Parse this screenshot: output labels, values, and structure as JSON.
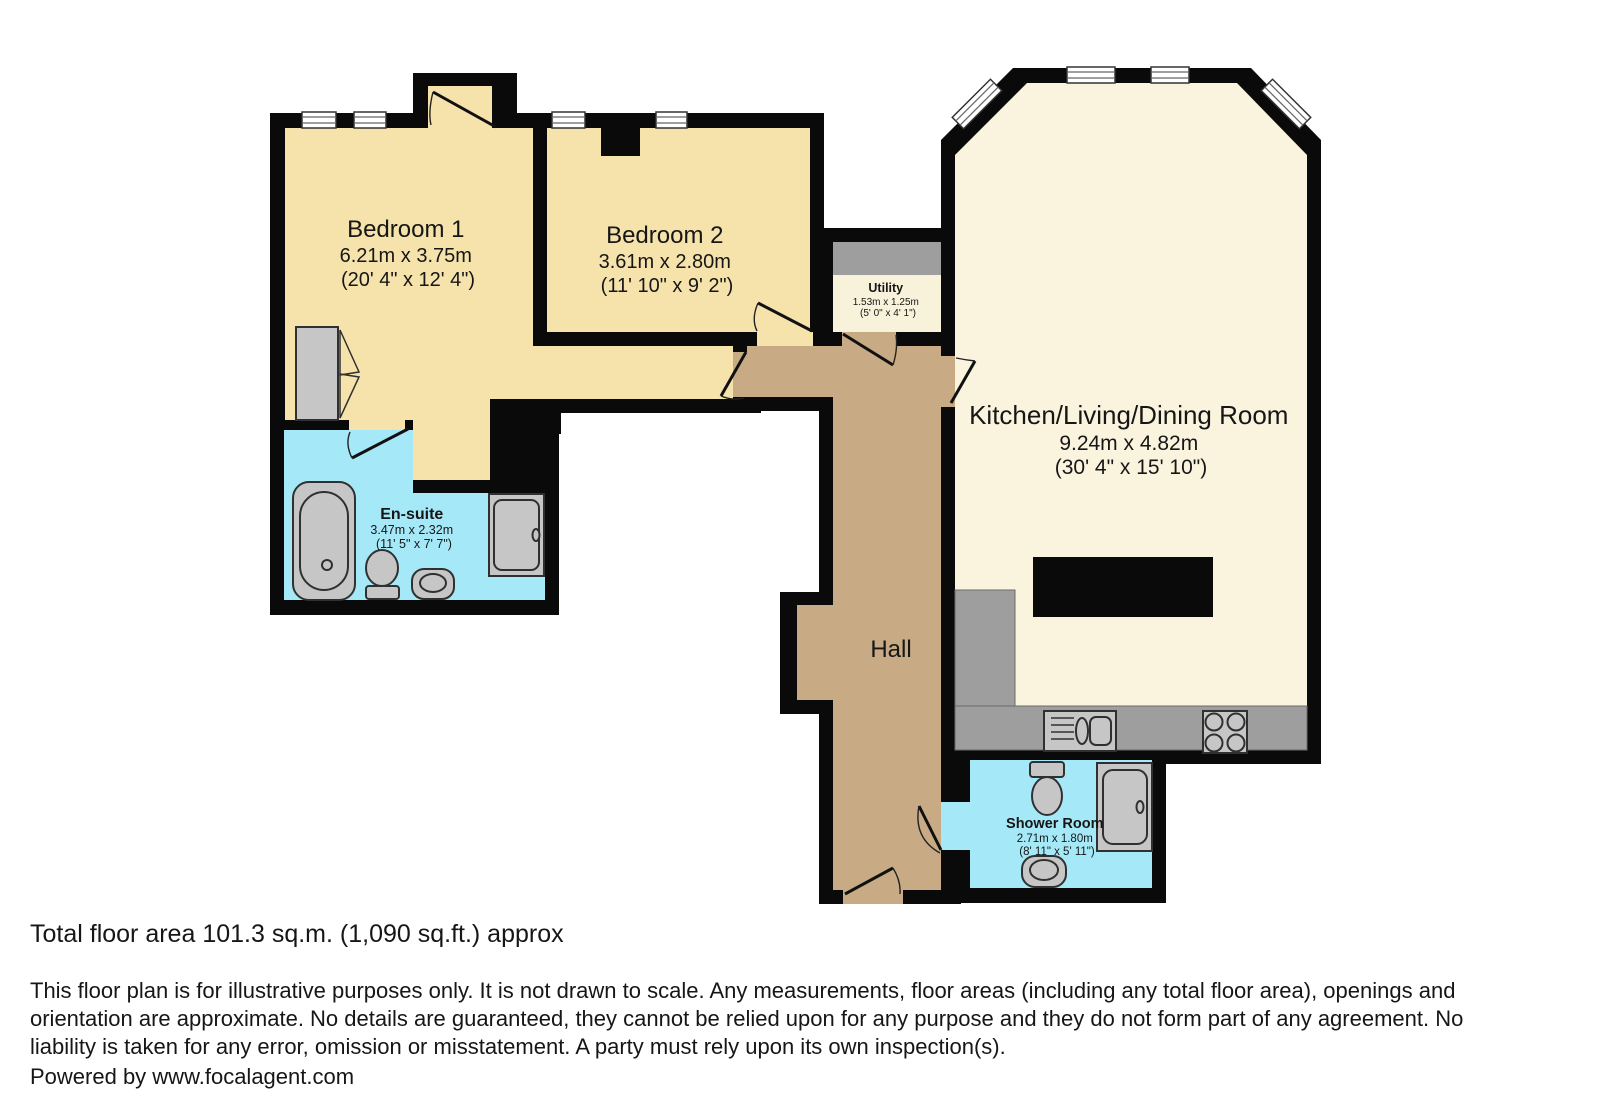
{
  "palette": {
    "wall": "#0a0a0a",
    "bedroom": "#f6e3ac",
    "kitchen": "#faf4de",
    "utility": "#f8f2db",
    "hall": "#c8ab85",
    "bath": "#a5e9f8",
    "counter": "#9e9e9e",
    "fixture": "#c6c6c6",
    "fixture-stroke": "#303030"
  },
  "rooms": {
    "bedroom1": {
      "name": "Bedroom 1",
      "dims_m": "6.21m x 3.75m",
      "dims_ft": "(20' 4\" x 12' 4\")"
    },
    "bedroom2": {
      "name": "Bedroom 2",
      "dims_m": "3.61m x 2.80m",
      "dims_ft": "(11' 10\" x 9' 2\")"
    },
    "utility": {
      "name": "Utility",
      "dims_m": "1.53m x 1.25m",
      "dims_ft": "(5' 0\" x 4' 1\")"
    },
    "kitchen": {
      "name": "Kitchen/Living/Dining Room",
      "dims_m": "9.24m x 4.82m",
      "dims_ft": "(30' 4\" x 15' 10\")"
    },
    "ensuite": {
      "name": "En-suite",
      "dims_m": "3.47m x 2.32m",
      "dims_ft": "(11' 5\" x 7' 7\")"
    },
    "hall": {
      "name": "Hall"
    },
    "shower_room": {
      "name": "Shower Room",
      "dims_m": "2.71m x 1.80m",
      "dims_ft": "(8' 11\" x 5' 11\")"
    }
  },
  "footer": {
    "total_area": "Total floor area 101.3 sq.m. (1,090 sq.ft.) approx",
    "disclaimer": "This floor plan is for illustrative purposes only. It is not drawn to scale. Any measurements, floor areas (including any total floor area), openings and orientation are approximate. No details are guaranteed, they cannot be relied upon for any purpose and they do not form part of any agreement. No liability is taken for any error, omission or misstatement. A party must rely upon its own inspection(s).",
    "powered_by": "Powered by www.focalagent.com"
  }
}
